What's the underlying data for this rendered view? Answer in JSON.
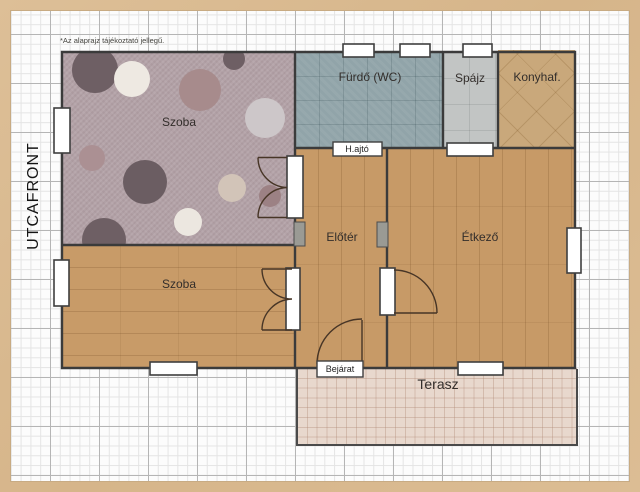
{
  "note": "*Az alaprajz tájékoztató jellegű.",
  "street_front_label": "UTCAFRONT",
  "rooms": {
    "szoba_top": {
      "label": "Szoba",
      "floor_type": "polka-dot-carpet",
      "floor_color": "#b4a3a8"
    },
    "furdo": {
      "label": "Fürdő (WC)",
      "floor_type": "tile",
      "floor_color": "#91a4a9"
    },
    "spajz": {
      "label": "Spájz",
      "floor_type": "tile",
      "floor_color": "#c2c5c4"
    },
    "konyha": {
      "label": "Konyhaf.",
      "floor_type": "diagonal-tile",
      "floor_color": "#c9a87b"
    },
    "eloter": {
      "label": "Előtér",
      "floor_type": "wood",
      "floor_color": "#c79a67"
    },
    "etkezo": {
      "label": "Étkező",
      "floor_type": "wood",
      "floor_color": "#c79a67"
    },
    "szoba_bottom": {
      "label": "Szoba",
      "floor_type": "wood",
      "floor_color": "#c89b68"
    },
    "terasz": {
      "label": "Terasz",
      "floor_type": "tile",
      "floor_color": "#e8d8cd"
    }
  },
  "doors": {
    "hajto": {
      "label": "H.ajtó"
    },
    "bejarat": {
      "label": "Bejárat"
    }
  },
  "colors": {
    "frame": "#d9ba92",
    "paper": "#fcfcfc",
    "grid_minor": "#e4e4e4",
    "grid_major": "#b5b5b5",
    "wall": "#3b3b3b",
    "window_fill": "#ffffff",
    "door_arc": "#473526",
    "passage_gray": "#9a9a94"
  }
}
